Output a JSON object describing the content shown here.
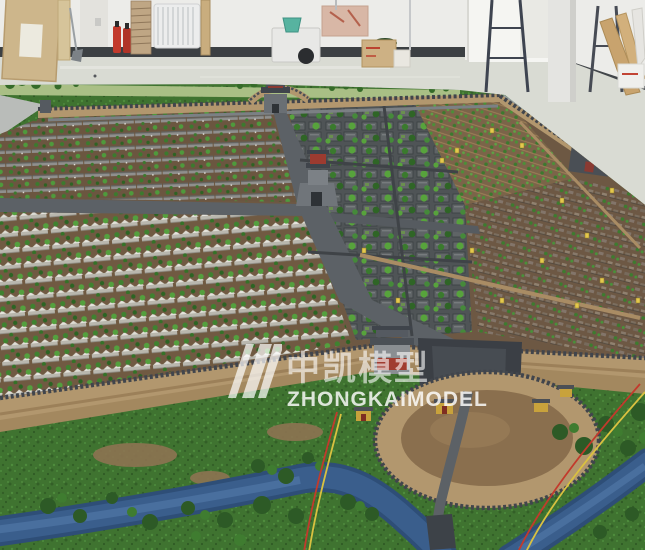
{
  "meta": {
    "alt": "Photograph of a large architectural scale model of an ancient Chinese walled city, displayed on a table inside a workshop"
  },
  "watermark": {
    "cn": "中凯模型",
    "en": "ZHONGKAIMODEL",
    "logo": "three-diagonal-stripes",
    "color": "#ffffff"
  },
  "palette": {
    "warehouse_wall": "#ecece9",
    "baseboard": "#3c4043",
    "floor": "#d9dbd3",
    "city_ground_brown": "#6d5843",
    "tree_green": "#3f8230",
    "road_grey": "#5c6166",
    "city_wall_tan": "#b2976e",
    "wall_top_grey": "#41454c",
    "river_blue": "#3a5e8c",
    "grass_green": "#3f7330",
    "sign_yellow": "#e3c84e",
    "wire_red": "#c23a2c",
    "wire_yellow": "#d9c140",
    "extinguisher_red": "#c23a2c",
    "bucket_teal": "#57b3a0"
  }
}
